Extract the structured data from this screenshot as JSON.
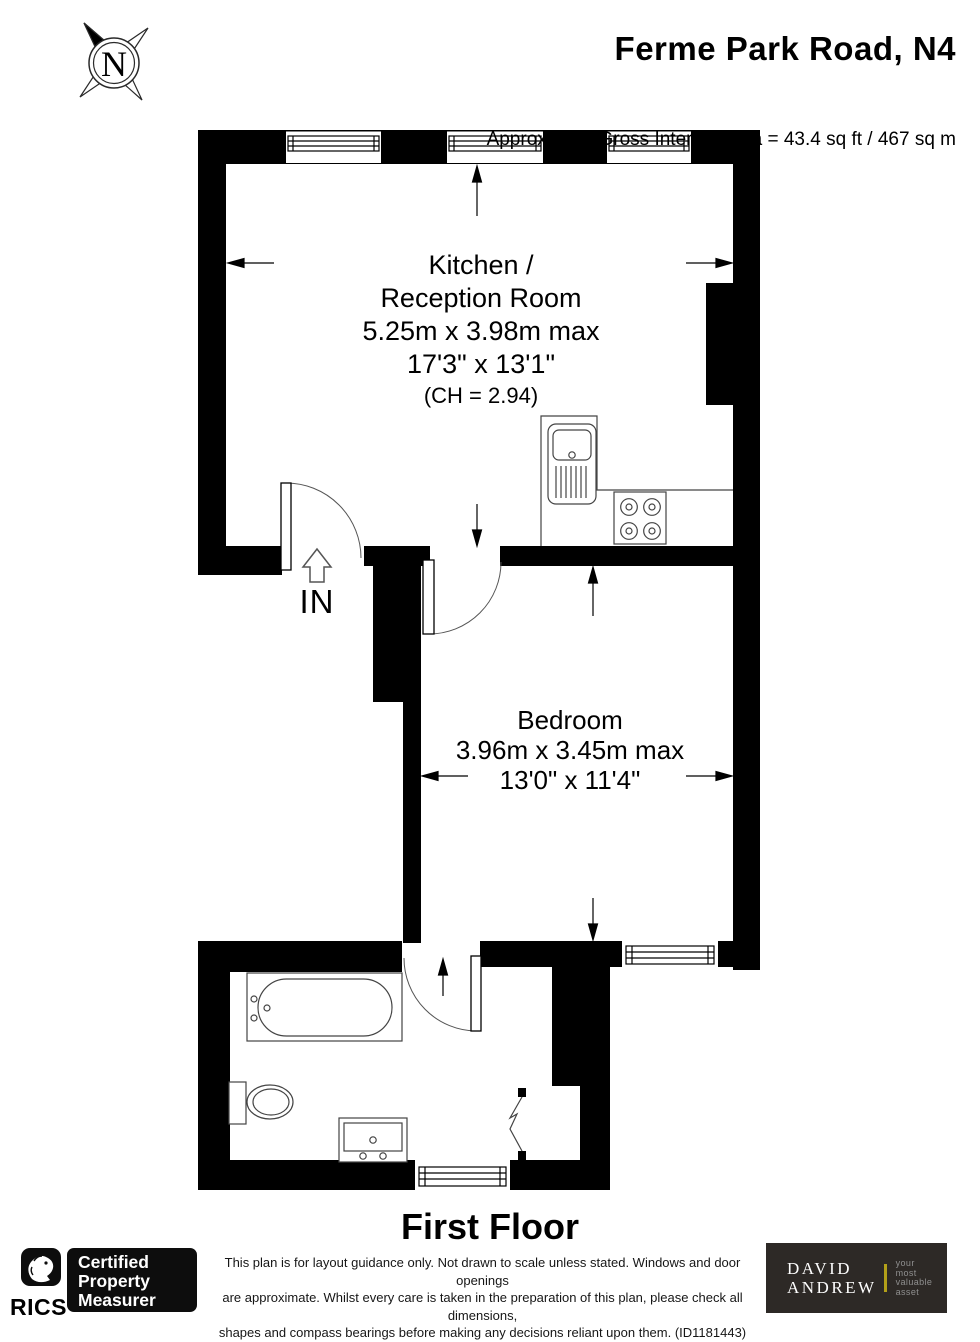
{
  "header": {
    "title": "Ferme Park Road, N4",
    "area_label": "Approximate Gross Internal Area = 43.4 sq ft / 467 sq m"
  },
  "compass": {
    "letter": "N"
  },
  "rooms": {
    "kitchen": {
      "name_line1": "Kitchen /",
      "name_line2": "Reception Room",
      "dim_metric": "5.25m x 3.98m max",
      "dim_imperial": "17'3\" x 13'1\"",
      "ceiling_height": "(CH = 2.94)"
    },
    "bedroom": {
      "name": "Bedroom",
      "dim_metric": "3.96m x 3.45m max",
      "dim_imperial": "13'0\" x 11'4\""
    }
  },
  "entrance_label": "IN",
  "floor_label": "First Floor",
  "footer": {
    "rics_label": "RICS",
    "rics_reg": "®",
    "badge_line1": "Certified",
    "badge_line2": "Property",
    "badge_line3": "Measurer",
    "disclaimer_lines": [
      "This plan is for layout guidance only. Not drawn to scale unless stated. Windows and door openings",
      "are approximate. Whilst every care is taken in the preparation of this plan, please check all dimensions,",
      "shapes and compass bearings before making any decisions reliant upon them. (ID1181443)"
    ],
    "agency_name_line1": "DAVID",
    "agency_name_line2": "ANDREW",
    "tagline_words": [
      "your",
      "most",
      "valuable",
      "asset"
    ]
  },
  "colors": {
    "wall": "#000000",
    "fixture_stroke": "#444444",
    "agency_bg": "#2d2926",
    "agency_accent": "#b3a019",
    "tagline_gray": "#8f8f8f"
  }
}
